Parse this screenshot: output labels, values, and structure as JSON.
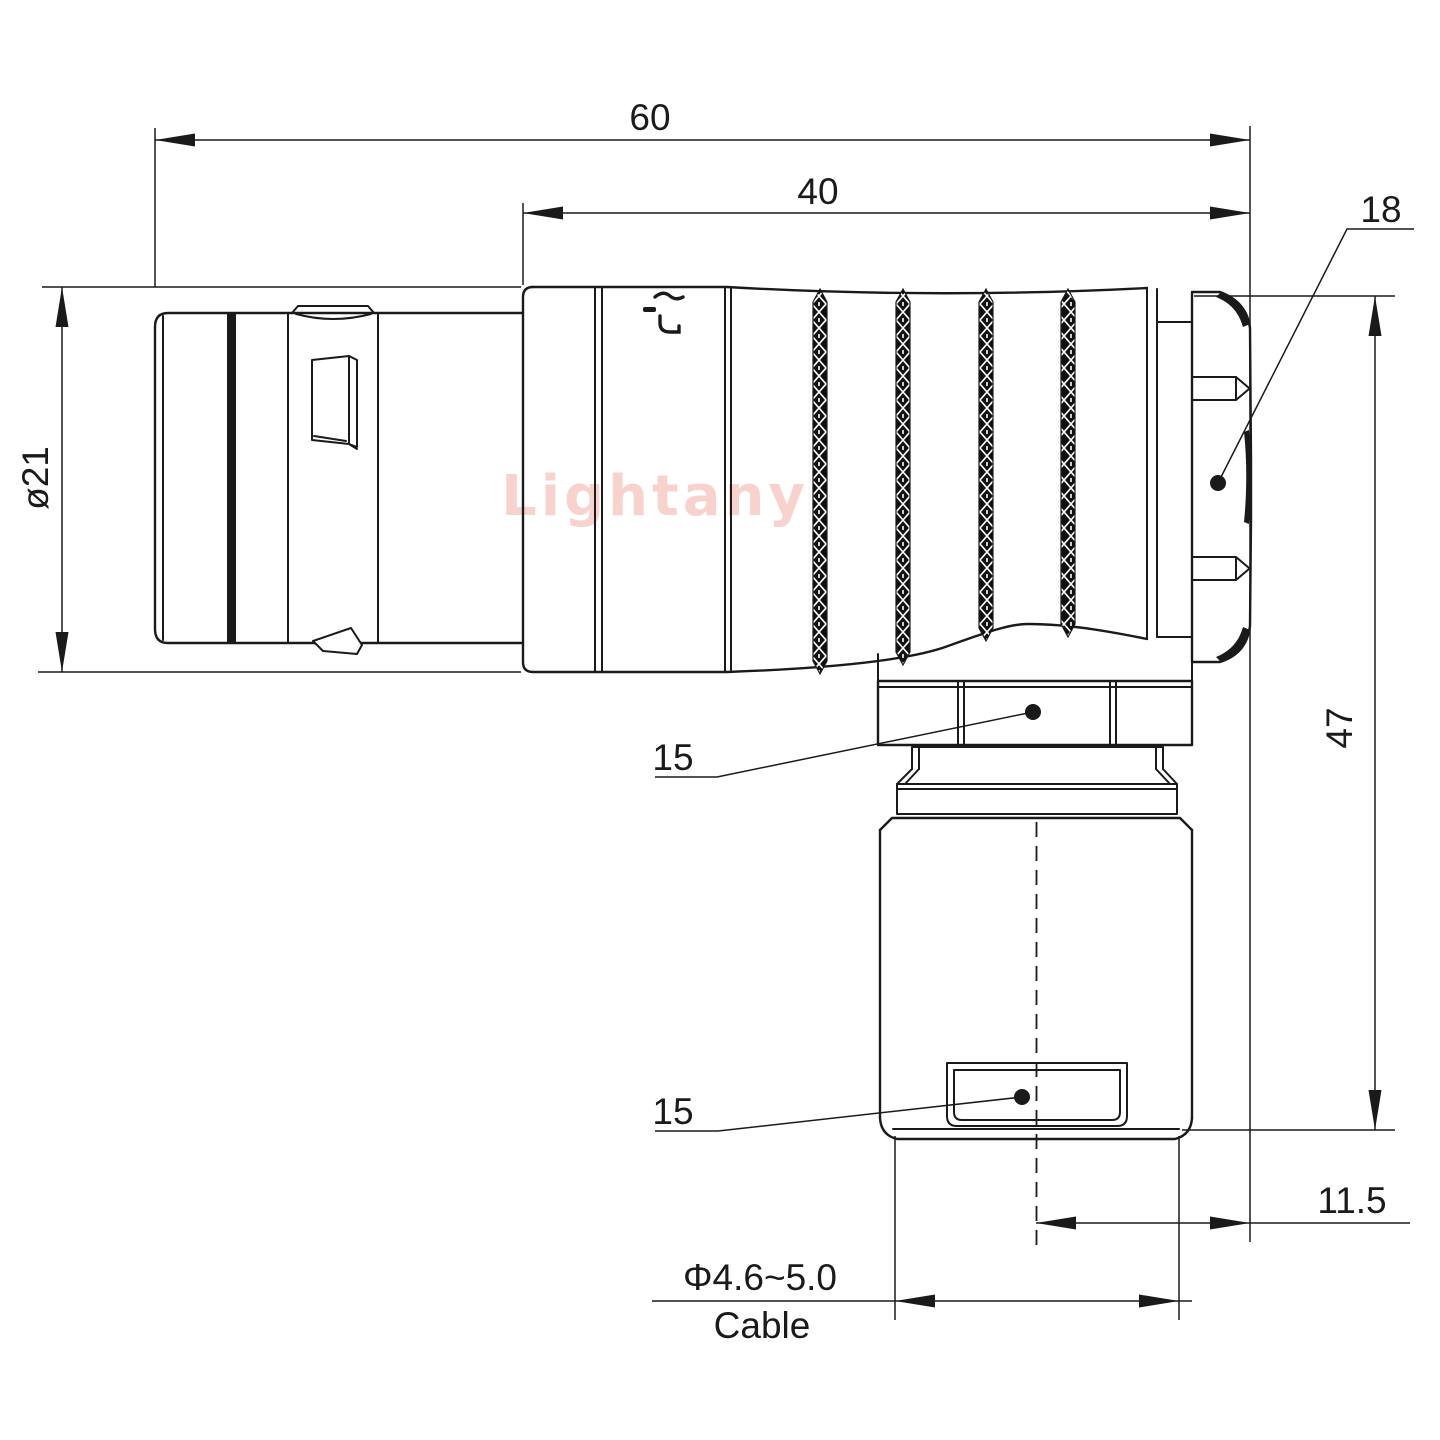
{
  "watermark": "Lightany",
  "dimensions": {
    "total_length": "60",
    "front_length": "40",
    "nut_across_flats": "18",
    "shell_diameter": "ø21",
    "total_height": "47",
    "coupling_nut_width": "15",
    "cable_clamp_width": "15",
    "exit_offset": "11.5",
    "cable_diameter_range": "Φ4.6~5.0",
    "cable_word": "Cable"
  },
  "icons": {
    "brand_mark": "lightany-logo",
    "leader_marker": "point-dot"
  },
  "colors": {
    "line": "#1a1a1a",
    "watermark": "#f8d3cd",
    "background": "#ffffff"
  }
}
